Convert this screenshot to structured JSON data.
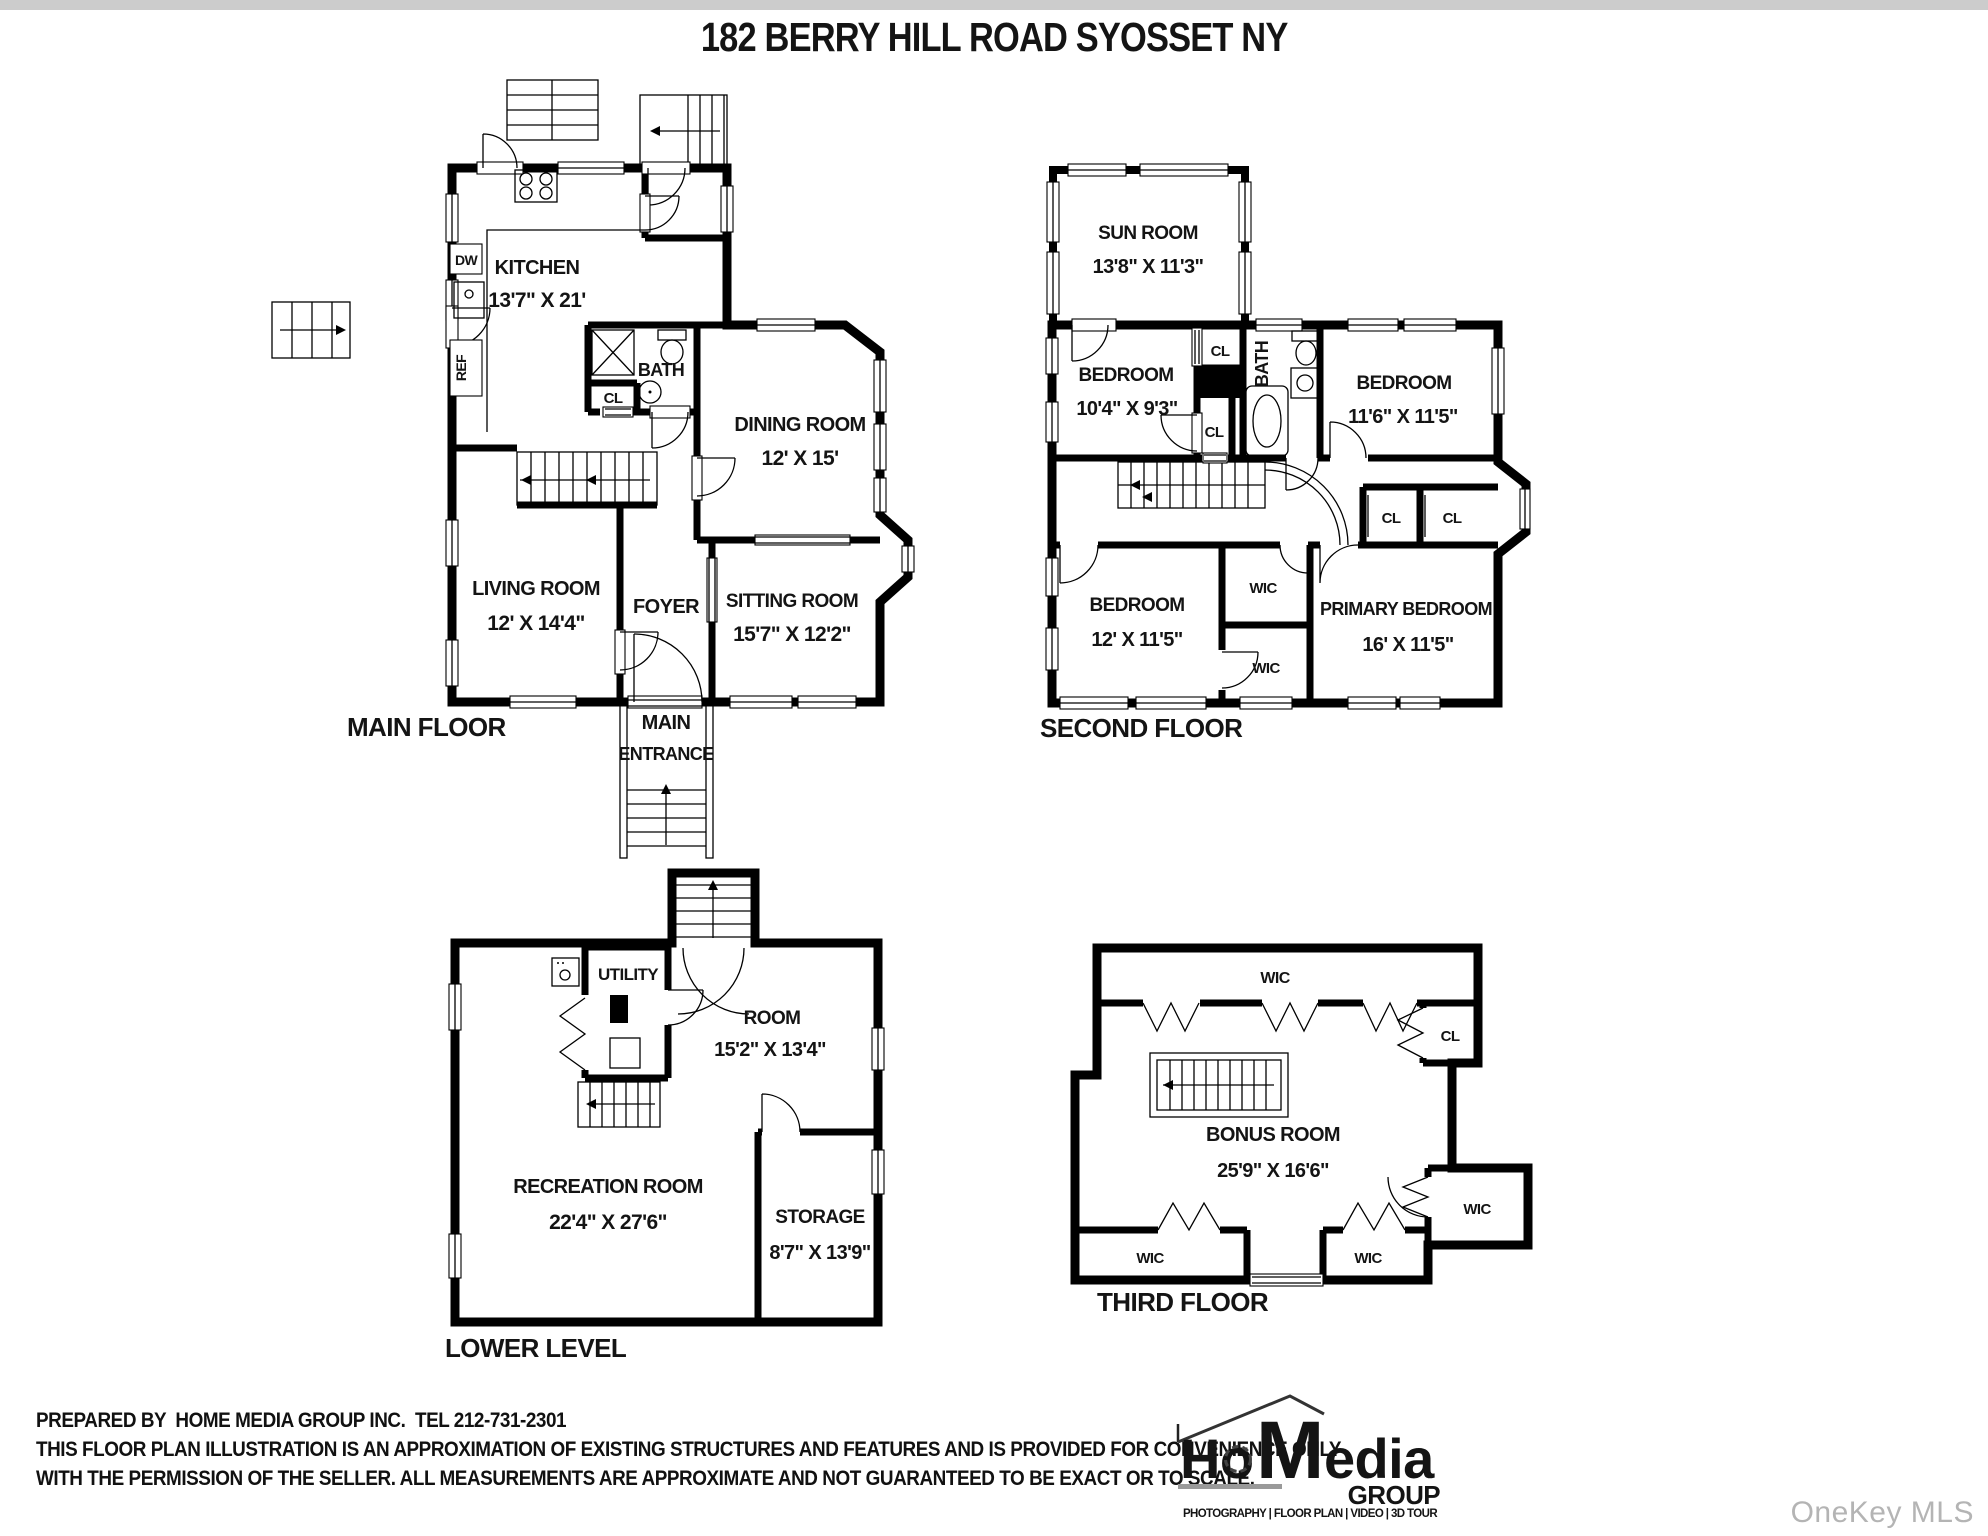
{
  "page": {
    "title": "182 BERRY HILL ROAD SYOSSET NY",
    "watermark": "OneKey MLS"
  },
  "floors": {
    "main": {
      "label": "MAIN FLOOR",
      "entrance_line1": "MAIN",
      "entrance_line2": "ENTRANCE",
      "kitchen_name": "KITCHEN",
      "kitchen_dims": "13'7\" X 21'",
      "dw": "DW",
      "ref": "REF",
      "bath": "BATH",
      "cl": "CL",
      "dining_name": "DINING ROOM",
      "dining_dims": "12' X 15'",
      "living_name": "LIVING ROOM",
      "living_dims": "12' X 14'4\"",
      "foyer": "FOYER",
      "sitting_name": "SITTING ROOM",
      "sitting_dims": "15'7\" X 12'2\""
    },
    "second": {
      "label": "SECOND FLOOR",
      "sunroom_name": "SUN ROOM",
      "sunroom_dims": "13'8\" X 11'3\"",
      "bedroom1_name": "BEDROOM",
      "bedroom1_dims": "10'4\" X 9'3\"",
      "bedroom2_name": "BEDROOM",
      "bedroom2_dims": "11'6\" X 11'5\"",
      "bedroom3_name": "BEDROOM",
      "bedroom3_dims": "12' X 11'5\"",
      "primary_name": "PRIMARY BEDROOM",
      "primary_dims": "16' X 11'5\"",
      "bath": "BATH",
      "cl": "CL",
      "wic": "WIC"
    },
    "lower": {
      "label": "LOWER LEVEL",
      "utility": "UTILITY",
      "room_name": "ROOM",
      "room_dims": "15'2\" X 13'4\"",
      "rec_name": "RECREATION ROOM",
      "rec_dims": "22'4\" X 27'6\"",
      "storage_name": "STORAGE",
      "storage_dims": "8'7\" X 13'9\""
    },
    "third": {
      "label": "THIRD FLOOR",
      "bonus_name": "BONUS ROOM",
      "bonus_dims": "25'9\" X 16'6\"",
      "wic": "WIC",
      "cl": "CL"
    }
  },
  "footer": {
    "line1": "PREPARED BY  HOME MEDIA GROUP INC.  TEL 212-731-2301",
    "line2": "THIS FLOOR PLAN ILLUSTRATION IS AN APPROXIMATION OF EXISTING STRUCTURES AND FEATURES AND IS PROVIDED FOR CONVENIENCE ONLY",
    "line3": "WITH THE PERMISSION OF THE SELLER. ALL MEASUREMENTS ARE APPROXIMATE AND NOT GUARANTEED TO BE EXACT OR TO SCALE."
  },
  "logo": {
    "ho": "Ho",
    "m": "M",
    "edia": "edia",
    "group": "GROUP",
    "tagline": "PHOTOGRAPHY | FLOOR PLAN | VIDEO | 3D TOUR"
  }
}
